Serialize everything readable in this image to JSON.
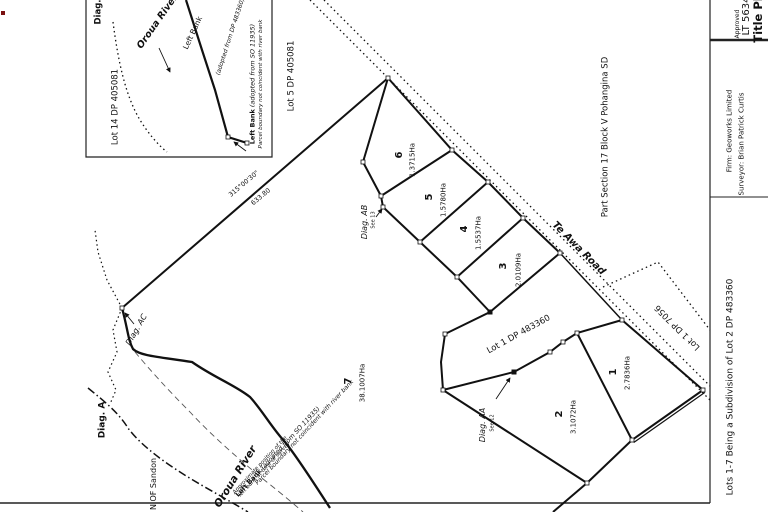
{
  "title_block": {
    "title": "Title Plan",
    "plan_id": "LT 5634",
    "approved": "Approved",
    "surveyor": "Surveyor: Brian Patrick Curtis",
    "firm": "Firm: Geoworks Limited",
    "description": "Lots 1-7 Being a Subdivision of Lot 2 DP 483360"
  },
  "inset": {
    "diag_label": "Diag.",
    "lot14": "Lot 14 DP 405081",
    "river": "Oroua River",
    "left_bank": "Left Bank",
    "adopted_dp": "(adopted from DP 483360)",
    "left_bank_bold": "Left Bank",
    "left_bank_rest": " (adopted from SO 11935)",
    "parcel_note": "Parcel boundary not coincident with river bank"
  },
  "plan": {
    "adjoining_lot5": "Lot 5 DP 405081",
    "part_section": "Part Section 17 Block V Pohangina SD",
    "road": "Te Awa Road",
    "lot1_dp7056": "Lot 1 DP 7056",
    "lot1_dp483360": "Lot 1 DP 483360",
    "town": "N OF Sandon",
    "river": "Oroua River",
    "bearing": "315°00'30\"",
    "distance": "633.80",
    "notes": {
      "left_bank_bold": "Left Bank",
      "left_bank_rest": " (adopted from SO 11935)",
      "parcel": "Parcel boundary not coincident with river bank",
      "approx_line1": "Approximate position of the",
      "approx_line2": "left bank at time of survey"
    },
    "diagrams": {
      "ab": "Diag. AB",
      "ab_see": "See 13",
      "aa": "Diag. AA",
      "aa_see": "See 12",
      "ac": "Diag. AC",
      "a": "Diag. A"
    },
    "lots": [
      {
        "number": "1",
        "area": "2.7836Ha"
      },
      {
        "number": "2",
        "area": "3.1072Ha"
      },
      {
        "number": "3",
        "area": "2.0109Ha"
      },
      {
        "number": "4",
        "area": "1.5537Ha"
      },
      {
        "number": "5",
        "area": "1.5780Ha"
      },
      {
        "number": "6",
        "area": "1.3715Ha"
      },
      {
        "number": "7",
        "area": "38.1007Ha"
      }
    ]
  }
}
